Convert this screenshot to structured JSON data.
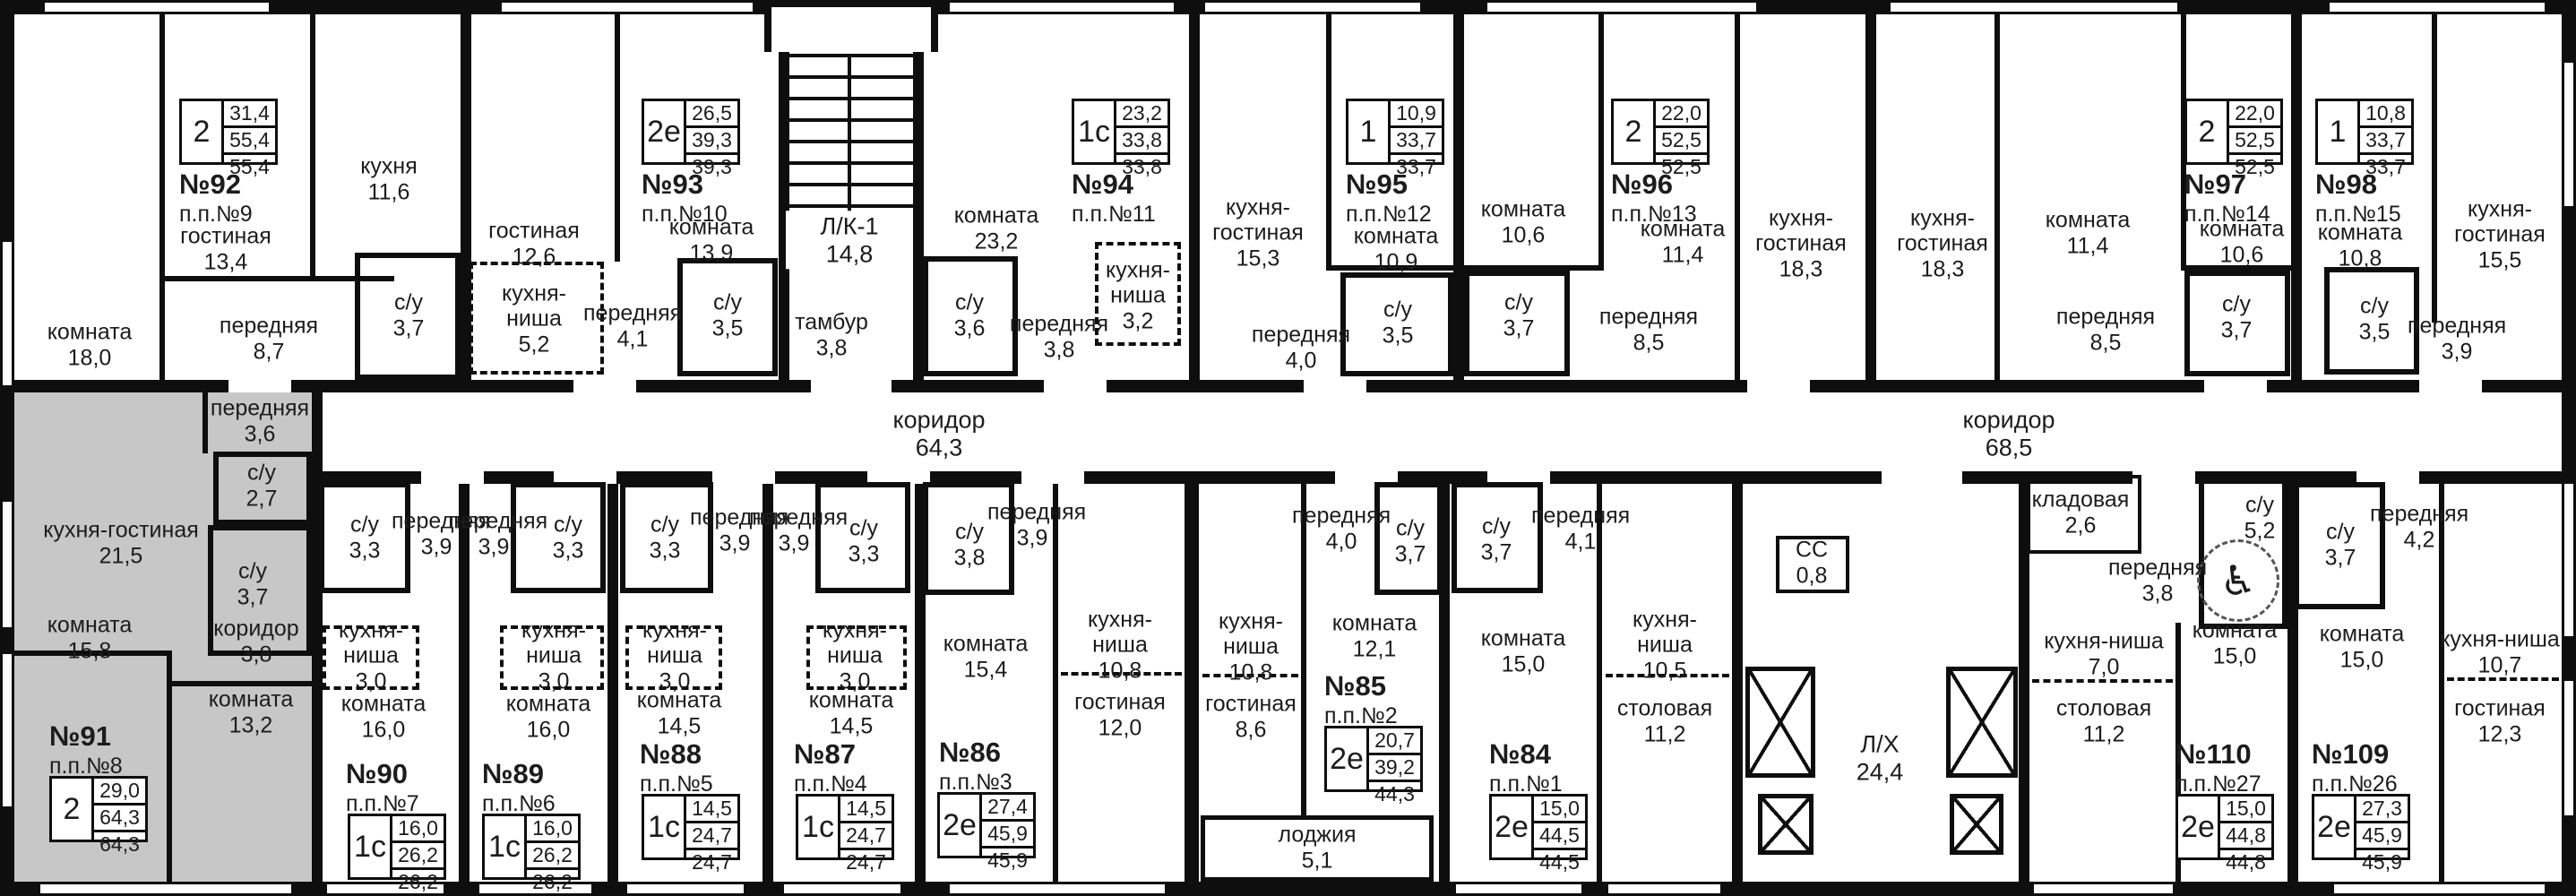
{
  "corridors": {
    "left": {
      "name": "коридор",
      "area": "64,3"
    },
    "right": {
      "name": "коридор",
      "area": "68,5"
    }
  },
  "core": {
    "stairs": {
      "name": "Л/К-1",
      "area": "14,8"
    },
    "tambour": {
      "name": "тамбур",
      "area": "3,8"
    },
    "cc": {
      "name": "СС",
      "area": "0,8"
    },
    "lift_hall": {
      "name": "Л/Х",
      "area": "24,4"
    },
    "loggia": {
      "name": "лоджия",
      "area": "5,1"
    }
  },
  "icons": {
    "wheelchair": "♿"
  },
  "colors": {
    "wall": "#0e0e0e",
    "paper": "#ffffff",
    "highlight": "#c7c7c7"
  },
  "apartments": {
    "a92": {
      "num": "№92",
      "pp": "п.п.№9",
      "type": "2",
      "v": [
        "31,4",
        "55,4",
        "55,4"
      ],
      "rooms": {
        "komnata": {
          "name": "комната",
          "area": "18,0"
        },
        "gostinaya": {
          "name": "гостиная",
          "area": "13,4"
        },
        "kuhnya": {
          "name": "кухня",
          "area": "11,6"
        },
        "perednyaya": {
          "name": "передняя",
          "area": "8,7"
        },
        "su": {
          "name": "с/у",
          "area": "3,7"
        }
      }
    },
    "a93": {
      "num": "№93",
      "pp": "п.п.№10",
      "type": "2е",
      "v": [
        "26,5",
        "39,3",
        "39,3"
      ],
      "rooms": {
        "gostinaya": {
          "name": "гостиная",
          "area": "12,6"
        },
        "kuhnya_nisha": {
          "name": "кухня-ниша",
          "area": "5,2"
        },
        "perednyaya": {
          "name": "передняя",
          "area": "4,1"
        },
        "komnata": {
          "name": "комната",
          "area": "13,9"
        },
        "su": {
          "name": "с/у",
          "area": "3,5"
        }
      }
    },
    "a94": {
      "num": "№94",
      "pp": "п.п.№11",
      "type": "1с",
      "v": [
        "23,2",
        "33,8",
        "33,8"
      ],
      "rooms": {
        "komnata": {
          "name": "комната",
          "area": "23,2"
        },
        "su": {
          "name": "с/у",
          "area": "3,6"
        },
        "perednyaya": {
          "name": "передняя",
          "area": "3,8"
        },
        "kuhnya_nisha": {
          "name": "кухня-ниша",
          "area": "3,2"
        }
      }
    },
    "a95": {
      "num": "№95",
      "pp": "п.п.№12",
      "type": "1",
      "v": [
        "10,9",
        "33,7",
        "33,7"
      ],
      "rooms": {
        "kuhnya_gostinaya": {
          "name": "кухня-гостиная",
          "area": "15,3"
        },
        "komnata": {
          "name": "комната",
          "area": "10,9"
        },
        "su": {
          "name": "с/у",
          "area": "3,5"
        },
        "perednyaya": {
          "name": "передняя",
          "area": "4,0"
        }
      }
    },
    "a96": {
      "num": "№96",
      "pp": "п.п.№13",
      "type": "2",
      "v": [
        "22,0",
        "52,5",
        "52,5"
      ],
      "rooms": {
        "komnata1": {
          "name": "комната",
          "area": "10,6"
        },
        "komnata2": {
          "name": "комната",
          "area": "11,4"
        },
        "su": {
          "name": "с/у",
          "area": "3,7"
        },
        "perednyaya": {
          "name": "передняя",
          "area": "8,5"
        },
        "kuhnya_gostinaya": {
          "name": "кухня-гостиная",
          "area": "18,3"
        }
      }
    },
    "a97": {
      "num": "№97",
      "pp": "п.п.№14",
      "type": "2",
      "v": [
        "22,0",
        "52,5",
        "52,5"
      ],
      "rooms": {
        "kuhnya_gostinaya": {
          "name": "кухня-гостиная",
          "area": "18,3"
        },
        "komnata1": {
          "name": "комната",
          "area": "11,4"
        },
        "perednyaya": {
          "name": "передняя",
          "area": "8,5"
        },
        "komnata2": {
          "name": "комната",
          "area": "10,6"
        },
        "su": {
          "name": "с/у",
          "area": "3,7"
        }
      }
    },
    "a98": {
      "num": "№98",
      "pp": "п.п.№15",
      "type": "1",
      "v": [
        "10,8",
        "33,7",
        "33,7"
      ],
      "rooms": {
        "komnata": {
          "name": "комната",
          "area": "10,8"
        },
        "su": {
          "name": "с/у",
          "area": "3,5"
        },
        "perednyaya": {
          "name": "передняя",
          "area": "3,9"
        },
        "kuhnya_gostinaya": {
          "name": "кухня-гостиная",
          "area": "15,5"
        }
      }
    },
    "a91": {
      "num": "№91",
      "pp": "п.п.№8",
      "type": "2",
      "v": [
        "29,0",
        "64,3",
        "64,3"
      ],
      "rooms": {
        "kuhnya_gostinaya": {
          "name": "кухня-гостиная",
          "area": "21,5"
        },
        "perednyaya": {
          "name": "передняя",
          "area": "3,6"
        },
        "su1": {
          "name": "с/у",
          "area": "2,7"
        },
        "su2": {
          "name": "с/у",
          "area": "3,7"
        },
        "koridor": {
          "name": "коридор",
          "area": "3,8"
        },
        "komnata1": {
          "name": "комната",
          "area": "15,8"
        },
        "komnata2": {
          "name": "комната",
          "area": "13,2"
        }
      }
    },
    "a90": {
      "num": "№90",
      "pp": "п.п.№7",
      "type": "1с",
      "v": [
        "16,0",
        "26,2",
        "26,2"
      ],
      "rooms": {
        "su": {
          "name": "с/у",
          "area": "3,3"
        },
        "perednyaya": {
          "name": "передняя",
          "area": "3,9"
        },
        "kuhnya_nisha": {
          "name": "кухня-ниша",
          "area": "3,0"
        },
        "komnata": {
          "name": "комната",
          "area": "16,0"
        }
      }
    },
    "a89": {
      "num": "№89",
      "pp": "п.п.№6",
      "type": "1с",
      "v": [
        "16,0",
        "26,2",
        "26,2"
      ],
      "rooms": {
        "perednyaya": {
          "name": "передняя",
          "area": "3,9"
        },
        "su": {
          "name": "с/у",
          "area": "3,3"
        },
        "kuhnya_nisha": {
          "name": "кухня-ниша",
          "area": "3,0"
        },
        "komnata": {
          "name": "комната",
          "area": "16,0"
        }
      }
    },
    "a88": {
      "num": "№88",
      "pp": "п.п.№5",
      "type": "1с",
      "v": [
        "14,5",
        "24,7",
        "24,7"
      ],
      "rooms": {
        "su": {
          "name": "с/у",
          "area": "3,3"
        },
        "perednyaya": {
          "name": "передняя",
          "area": "3,9"
        },
        "kuhnya_nisha": {
          "name": "кухня-ниша",
          "area": "3,0"
        },
        "komnata": {
          "name": "комната",
          "area": "14,5"
        }
      }
    },
    "a87": {
      "num": "№87",
      "pp": "п.п.№4",
      "type": "1с",
      "v": [
        "14,5",
        "24,7",
        "24,7"
      ],
      "rooms": {
        "perednyaya": {
          "name": "передняя",
          "area": "3,9"
        },
        "su": {
          "name": "с/у",
          "area": "3,3"
        },
        "kuhnya_nisha": {
          "name": "кухня-ниша",
          "area": "3,0"
        },
        "komnata": {
          "name": "комната",
          "area": "14,5"
        }
      }
    },
    "a86": {
      "num": "№86",
      "pp": "п.п.№3",
      "type": "2е",
      "v": [
        "27,4",
        "45,9",
        "45,9"
      ],
      "rooms": {
        "su": {
          "name": "с/у",
          "area": "3,8"
        },
        "perednyaya": {
          "name": "передняя",
          "area": "3,9"
        },
        "komnata": {
          "name": "комната",
          "area": "15,4"
        },
        "kuhnya_nisha": {
          "name": "кухня-ниша",
          "area": "10,8"
        },
        "gostinaya": {
          "name": "гостиная",
          "area": "12,0"
        }
      }
    },
    "a85": {
      "num": "№85",
      "pp": "п.п.№2",
      "type": "2е",
      "v": [
        "20,7",
        "39,2",
        "44,3"
      ],
      "rooms": {
        "kuhnya_nisha": {
          "name": "кухня-ниша",
          "area": "10,8"
        },
        "gostinaya": {
          "name": "гостиная",
          "area": "8,6"
        },
        "perednyaya": {
          "name": "передняя",
          "area": "4,0"
        },
        "su": {
          "name": "с/у",
          "area": "3,7"
        },
        "komnata": {
          "name": "комната",
          "area": "12,1"
        }
      }
    },
    "a84": {
      "num": "№84",
      "pp": "п.п.№1",
      "type": "2е",
      "v": [
        "15,0",
        "44,5",
        "44,5"
      ],
      "rooms": {
        "su": {
          "name": "с/у",
          "area": "3,7"
        },
        "perednyaya": {
          "name": "передняя",
          "area": "4,1"
        },
        "komnata": {
          "name": "комната",
          "area": "15,0"
        },
        "kuhnya_nisha": {
          "name": "кухня-ниша",
          "area": "10,5"
        },
        "stolovaya": {
          "name": "столовая",
          "area": "11,2"
        }
      }
    },
    "a110": {
      "num": "№110",
      "pp": "п.п.№27",
      "type": "2е",
      "v": [
        "15,0",
        "44,8",
        "44,8"
      ],
      "rooms": {
        "kladovaya": {
          "name": "кладовая",
          "area": "2,6"
        },
        "perednyaya": {
          "name": "передняя",
          "area": "3,8"
        },
        "su": {
          "name": "с/у",
          "area": "5,2"
        },
        "kuhnya_nisha": {
          "name": "кухня-ниша",
          "area": "7,0"
        },
        "komnata": {
          "name": "комната",
          "area": "15,0"
        },
        "stolovaya": {
          "name": "столовая",
          "area": "11,2"
        }
      }
    },
    "a109": {
      "num": "№109",
      "pp": "п.п.№26",
      "type": "2е",
      "v": [
        "27,3",
        "45,9",
        "45,9"
      ],
      "rooms": {
        "su": {
          "name": "с/у",
          "area": "3,7"
        },
        "perednyaya": {
          "name": "передняя",
          "area": "4,2"
        },
        "komnata": {
          "name": "комната",
          "area": "15,0"
        },
        "kuhnya_nisha": {
          "name": "кухня-ниша",
          "area": "10,7"
        },
        "gostinaya": {
          "name": "гостиная",
          "area": "12,3"
        }
      }
    }
  }
}
